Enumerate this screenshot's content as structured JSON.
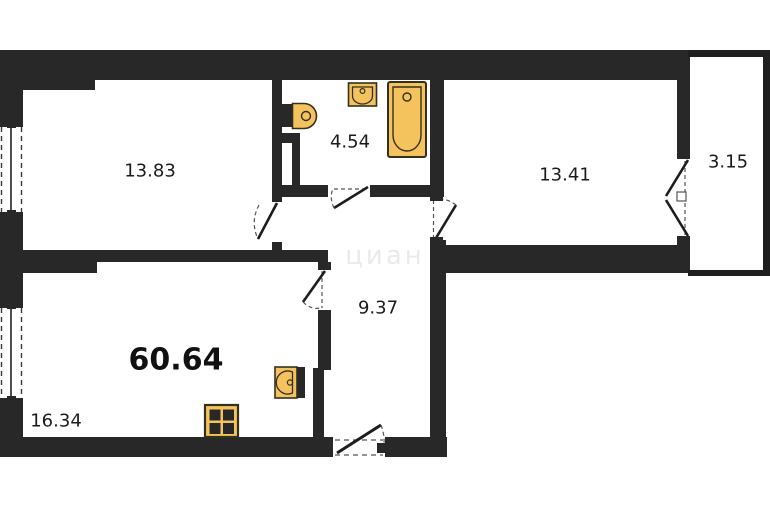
{
  "plan": {
    "title": "apartment-floor-plan",
    "total_area": "60.64",
    "rooms": [
      {
        "name": "living-room",
        "area": "13.83"
      },
      {
        "name": "bathroom",
        "area": "4.54"
      },
      {
        "name": "bedroom",
        "area": "13.41"
      },
      {
        "name": "balcony",
        "area": "3.15"
      },
      {
        "name": "hallway",
        "area": "9.37"
      },
      {
        "name": "kitchen",
        "area": "16.34"
      }
    ],
    "watermark": "циан",
    "fixtures": [
      "toilet-icon",
      "washbasin-icon",
      "bathtub-icon",
      "kitchen-sink-icon",
      "stove-icon"
    ],
    "colors": {
      "wall": "#282828",
      "fixture_fill": "#f5c35e",
      "fixture_stroke": "#33301f",
      "background": "#ffffff"
    }
  }
}
